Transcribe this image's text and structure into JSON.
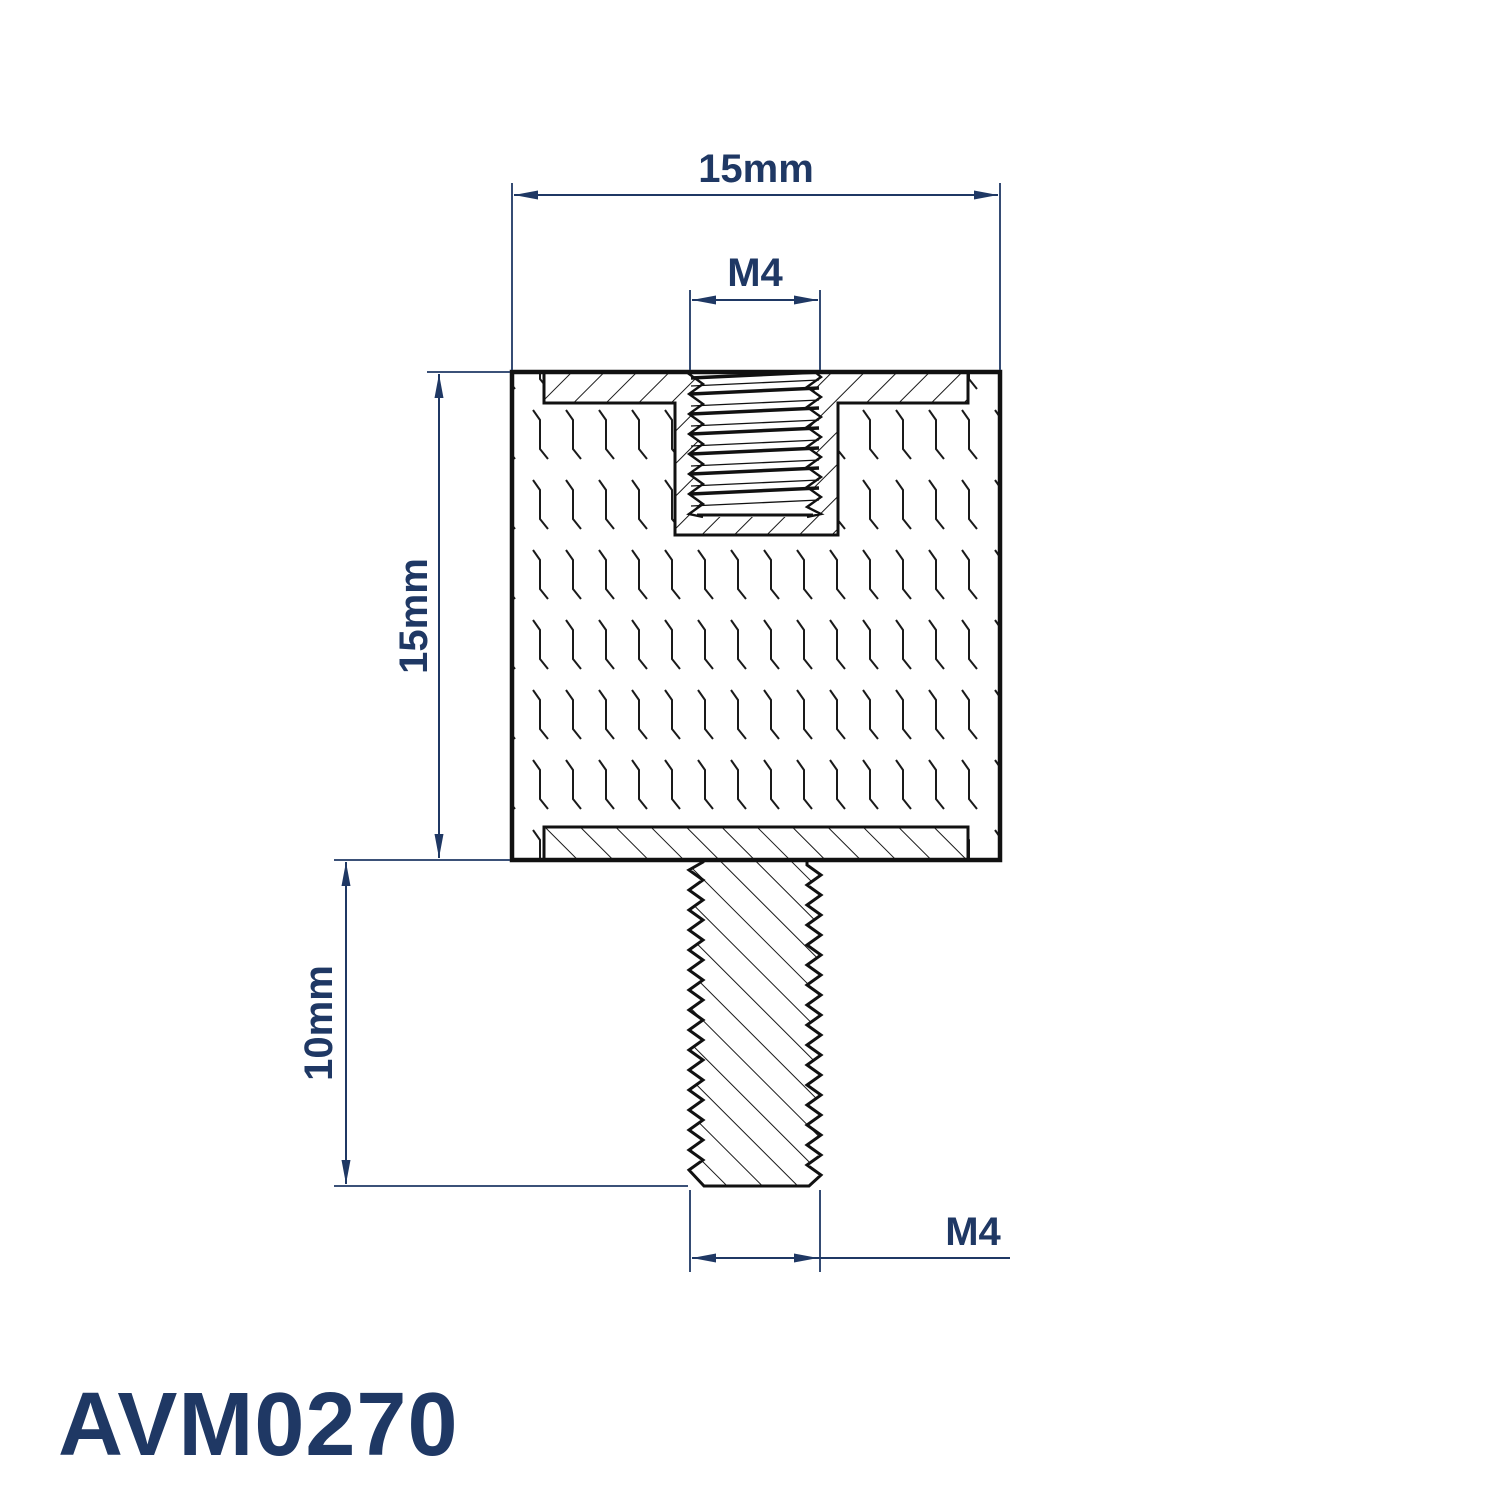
{
  "title": {
    "part_number": "AVM0270"
  },
  "colors": {
    "accent": "#1f3864",
    "line": "#111111",
    "background": "#ffffff"
  },
  "drawing": {
    "type": "technical-section-drawing",
    "part_kind": "anti-vibration mount, male-female standoff",
    "labels": {
      "top_width": "15mm",
      "hole_thread": "M4",
      "body_height": "15mm",
      "stud_length": "10mm",
      "stud_thread": "M4"
    }
  }
}
